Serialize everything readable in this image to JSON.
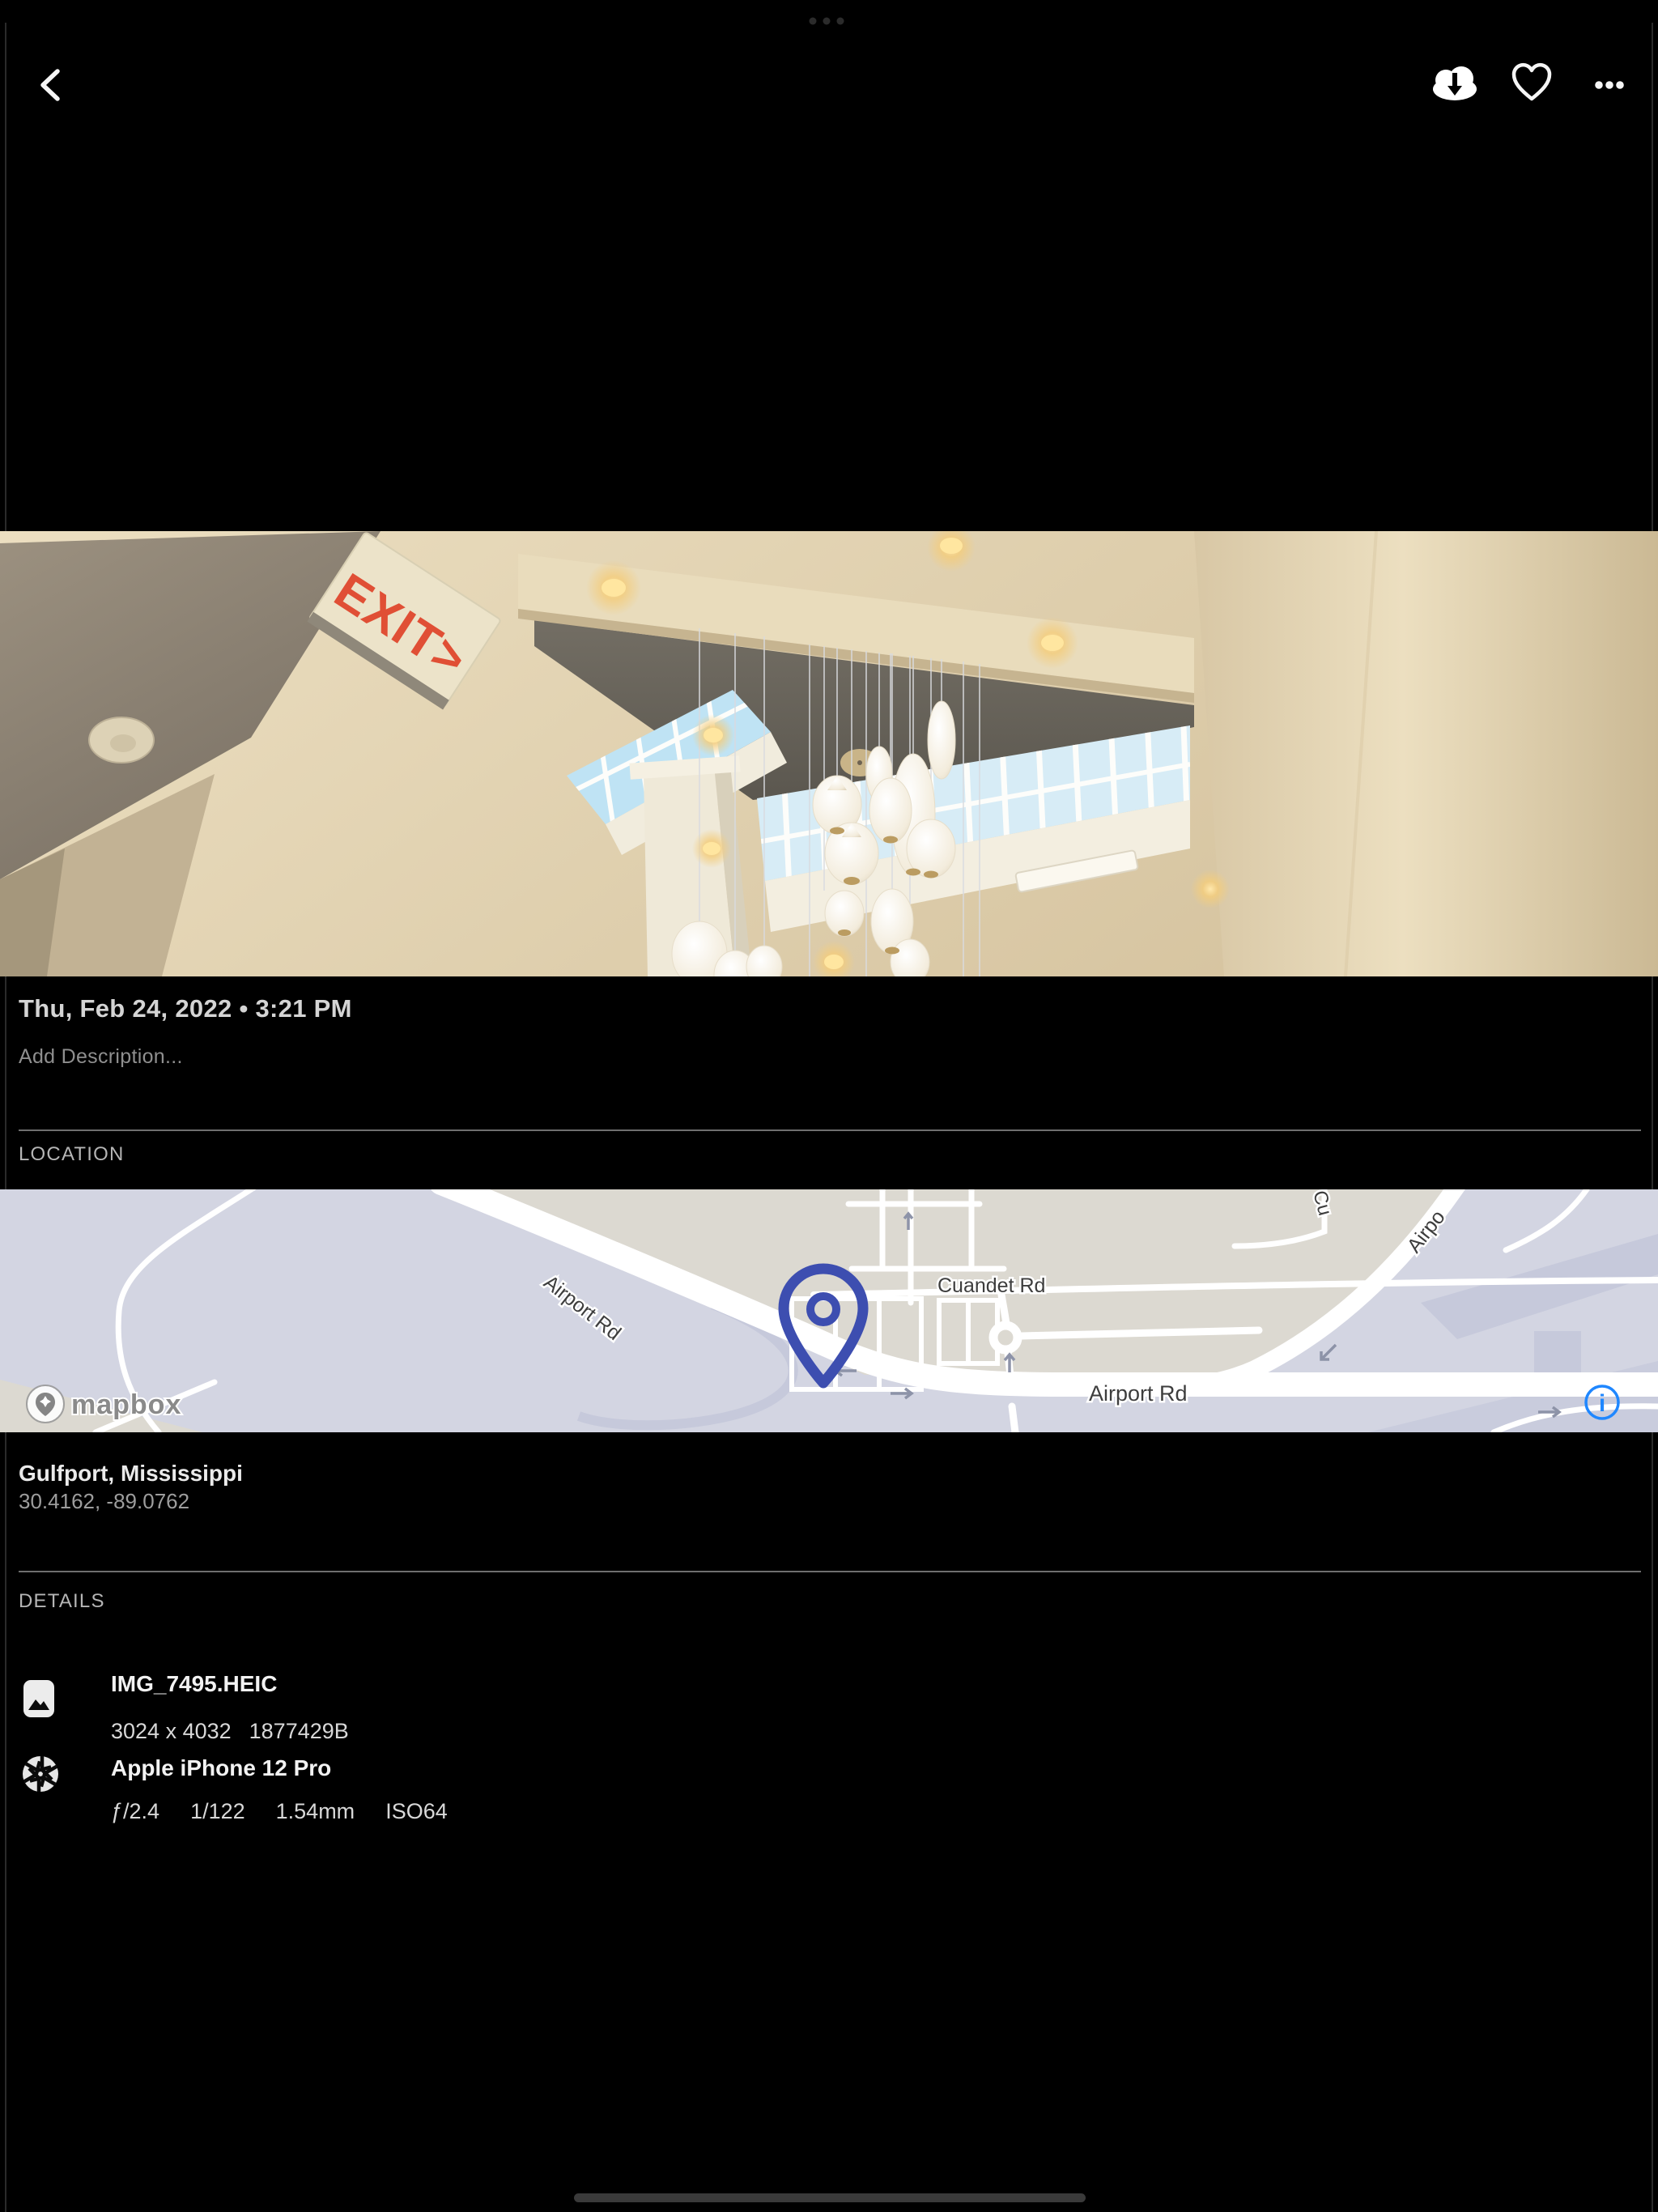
{
  "statusbar": {
    "multitask_dots": "• • •"
  },
  "photo": {
    "exit_sign_text": "EXIT>"
  },
  "meta": {
    "datetime": "Thu, Feb 24, 2022 • 3:21 PM",
    "description_placeholder": "Add Description..."
  },
  "location": {
    "label": "LOCATION",
    "place": "Gulfport, Mississippi",
    "coordinates": "30.4162, -89.0762",
    "map": {
      "road_label_diagonal": "Airport Rd",
      "road_label_cross": "Cuandet Rd",
      "road_label_main": "Airport Rd",
      "road_label_partial_top": "Cu",
      "road_label_partial_right": "Airpo",
      "attribution": "mapbox",
      "info_symbol": "i",
      "colors": {
        "pin": "#3d4eb0",
        "info_blue": "#1f87ff",
        "land": "#dcd9d1",
        "water": "#d3d5e2"
      }
    }
  },
  "details": {
    "label": "DETAILS",
    "file": {
      "name": "IMG_7495.HEIC",
      "dimensions": "3024 x 4032",
      "size": "1877429B"
    },
    "camera": {
      "name": "Apple iPhone 12 Pro",
      "specs": [
        "ƒ/2.4",
        "1/122",
        "1.54mm",
        "ISO64"
      ]
    }
  }
}
